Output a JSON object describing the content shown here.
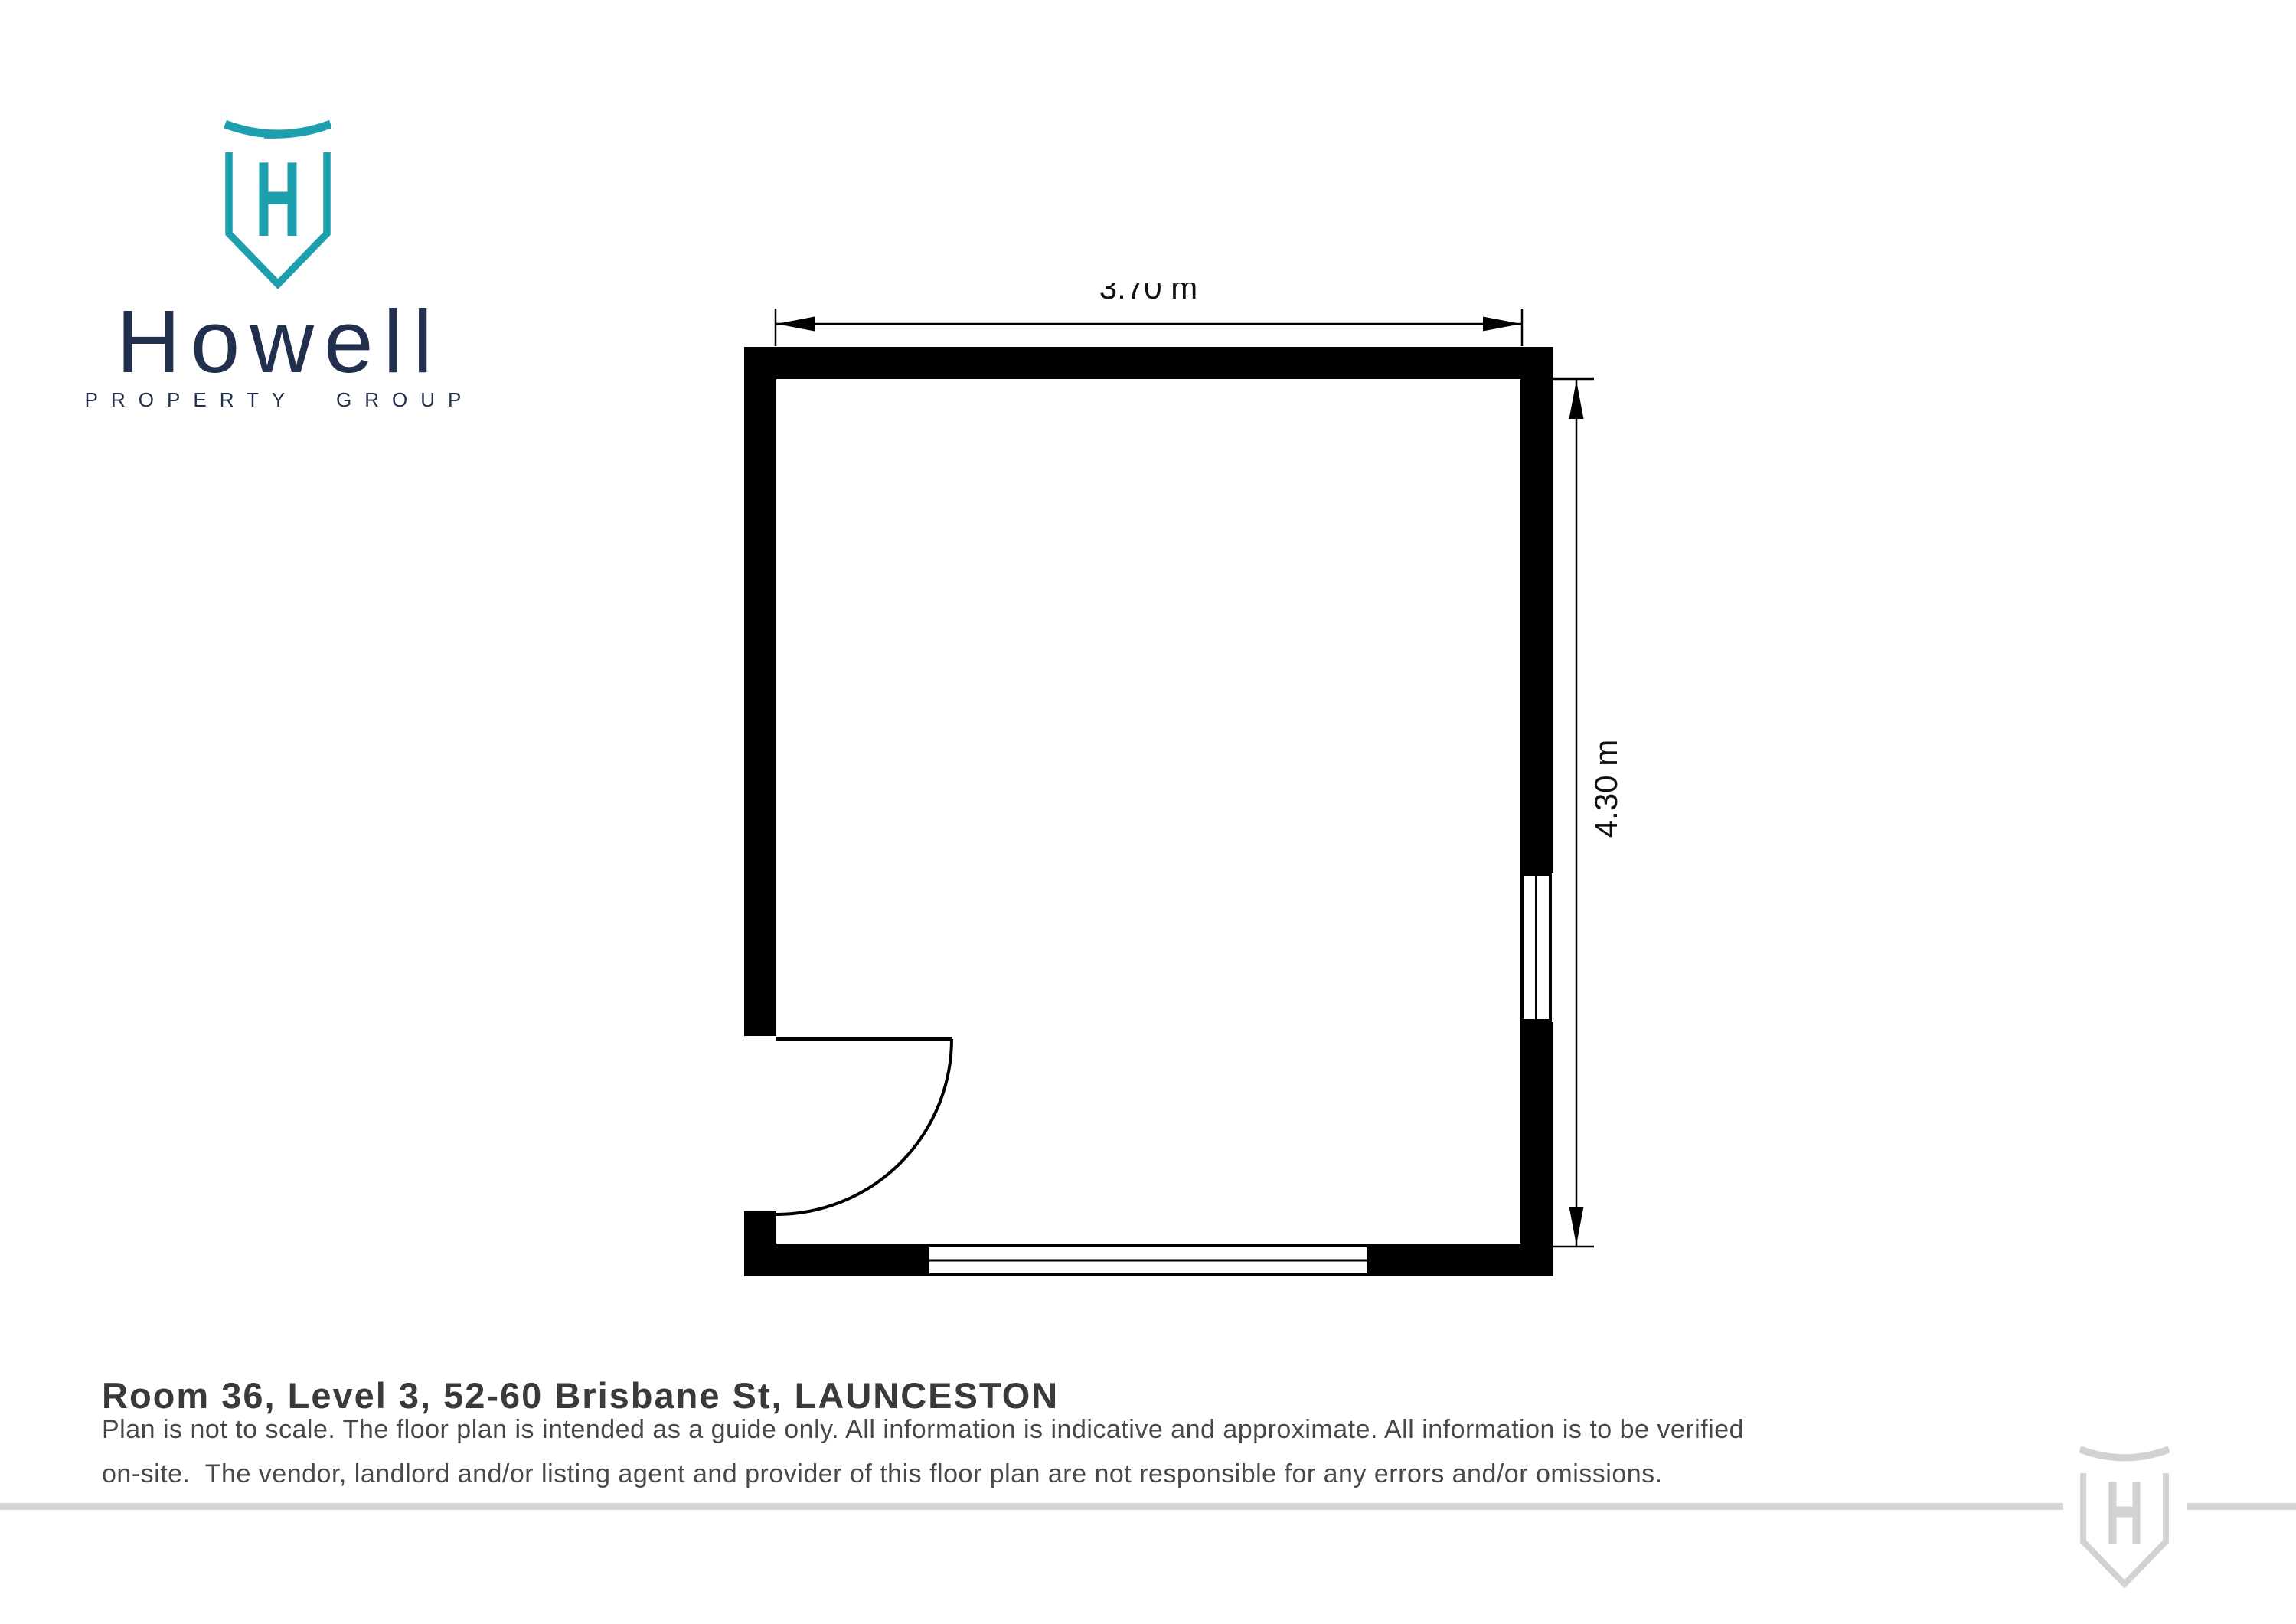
{
  "brand": {
    "name": "Howell",
    "tagline": "PROPERTY GROUP",
    "monogram": "H"
  },
  "plan": {
    "width_label": "3.70 m",
    "height_label": "4.30 m"
  },
  "footer": {
    "title": "Room 36, Level 3, 52-60 Brisbane St, LAUNCESTON",
    "disclaimer_line1": "Plan is not to scale. The floor plan is intended as a guide only. All information is indicative and approximate. All information is to be verified",
    "disclaimer_line2": "on-site.  The vendor, landlord and/or listing agent and provider of this floor plan are not responsible for any errors and/or omissions."
  },
  "colors": {
    "brand_teal": "#1d9fae",
    "brand_navy": "#22304d",
    "title_text": "#3a3a3a",
    "body_text": "#484848",
    "wall_black": "#000000",
    "watermark_gray": "#d2d2d2"
  }
}
